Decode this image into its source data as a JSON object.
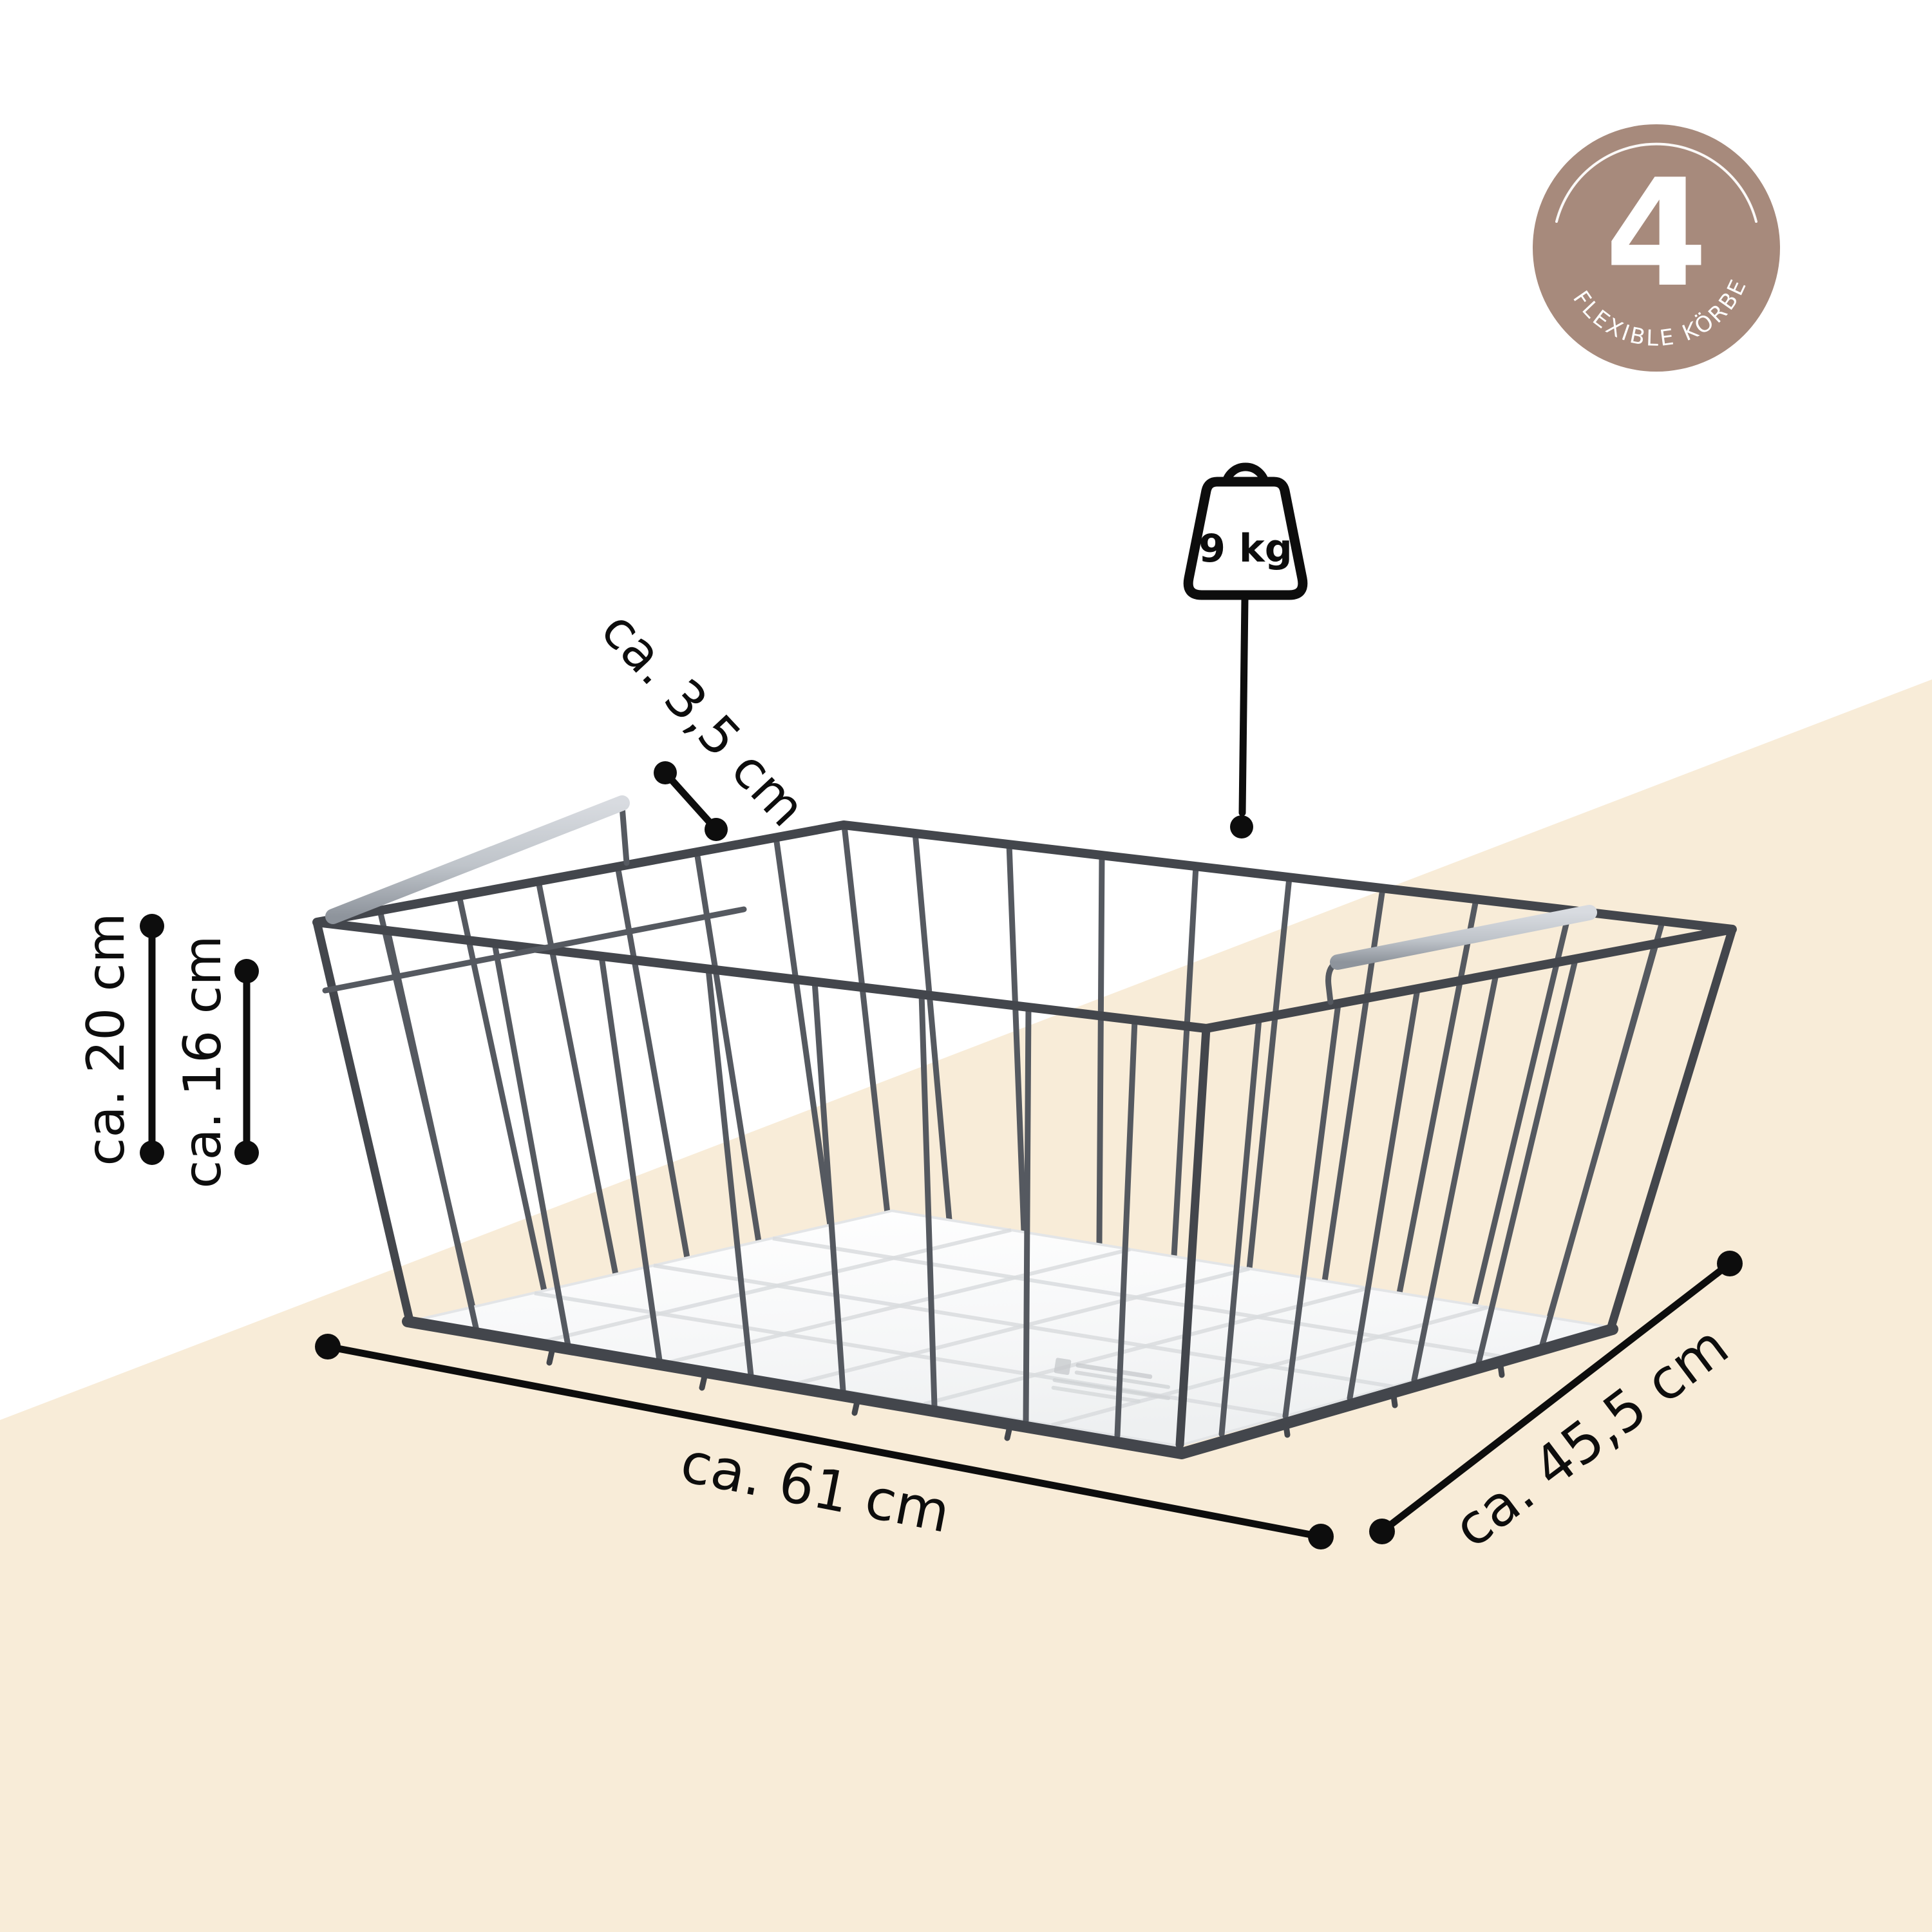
{
  "colors": {
    "annotation": "#0d0d0d",
    "beige": "#f8ecd8",
    "badge": "#a78a7c",
    "frame": "#43464c",
    "wire": "#555960",
    "base": "#fafbfc",
    "base_line": "#d9dcde",
    "silver_light": "#d8dbe0",
    "silver_dark": "#8e949c"
  },
  "badge": {
    "count": "4",
    "label": "FLEXIBLE KÖRBE"
  },
  "weight_limit": {
    "label": "9 kg"
  },
  "dimensions": {
    "height_outer": "ca. 20 cm",
    "height_inner": "ca. 16 cm",
    "clearance": "ca. 3,5 cm",
    "width": "ca. 61 cm",
    "depth": "ca. 45,5 cm"
  }
}
